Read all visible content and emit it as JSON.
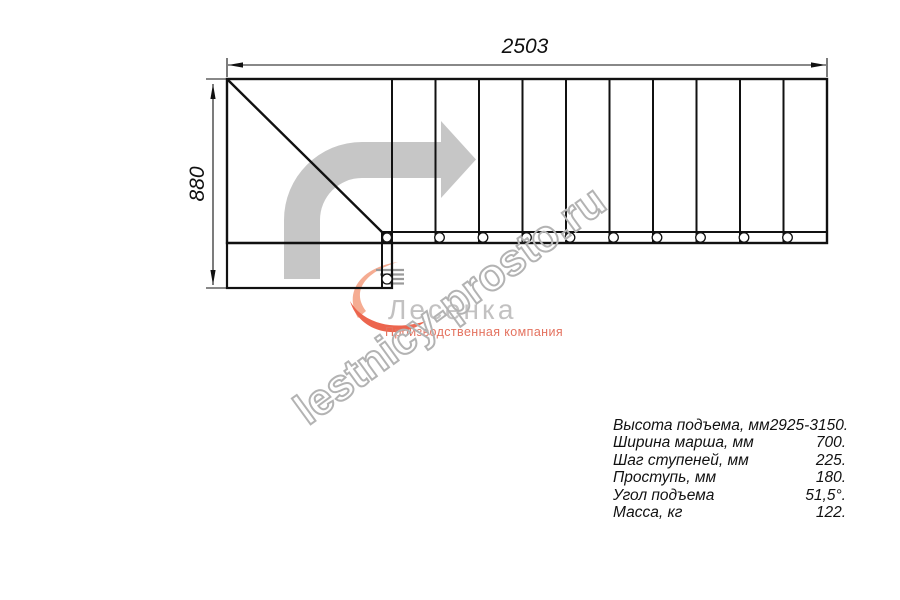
{
  "drawing": {
    "dim_width_label": "2503",
    "dim_height_label": "880",
    "treads_count": 10,
    "line_color": "#111111",
    "arrow_color": "#c6c6c6"
  },
  "watermark": {
    "text": "lestnicy-prosto.ru",
    "stroke_color": "#b3b3b3"
  },
  "logo": {
    "name": "Лесенка",
    "tagline": "Производственная компания",
    "name_color": "#c2c1c1",
    "tagline_color": "#e4725f",
    "mark_peach_color": "#f5ac92",
    "mark_coral_color": "#ec654e"
  },
  "specs": {
    "rows": [
      {
        "label": "Высота подъема, мм",
        "value": "2925-3150."
      },
      {
        "label": "Ширина марша, мм",
        "value": "700."
      },
      {
        "label": "Шаг ступеней, мм",
        "value": "225."
      },
      {
        "label": "Проступь, мм",
        "value": "180."
      },
      {
        "label": "Угол подъема",
        "value": "51,5°."
      },
      {
        "label": "Масса, кг",
        "value": "122."
      }
    ]
  }
}
